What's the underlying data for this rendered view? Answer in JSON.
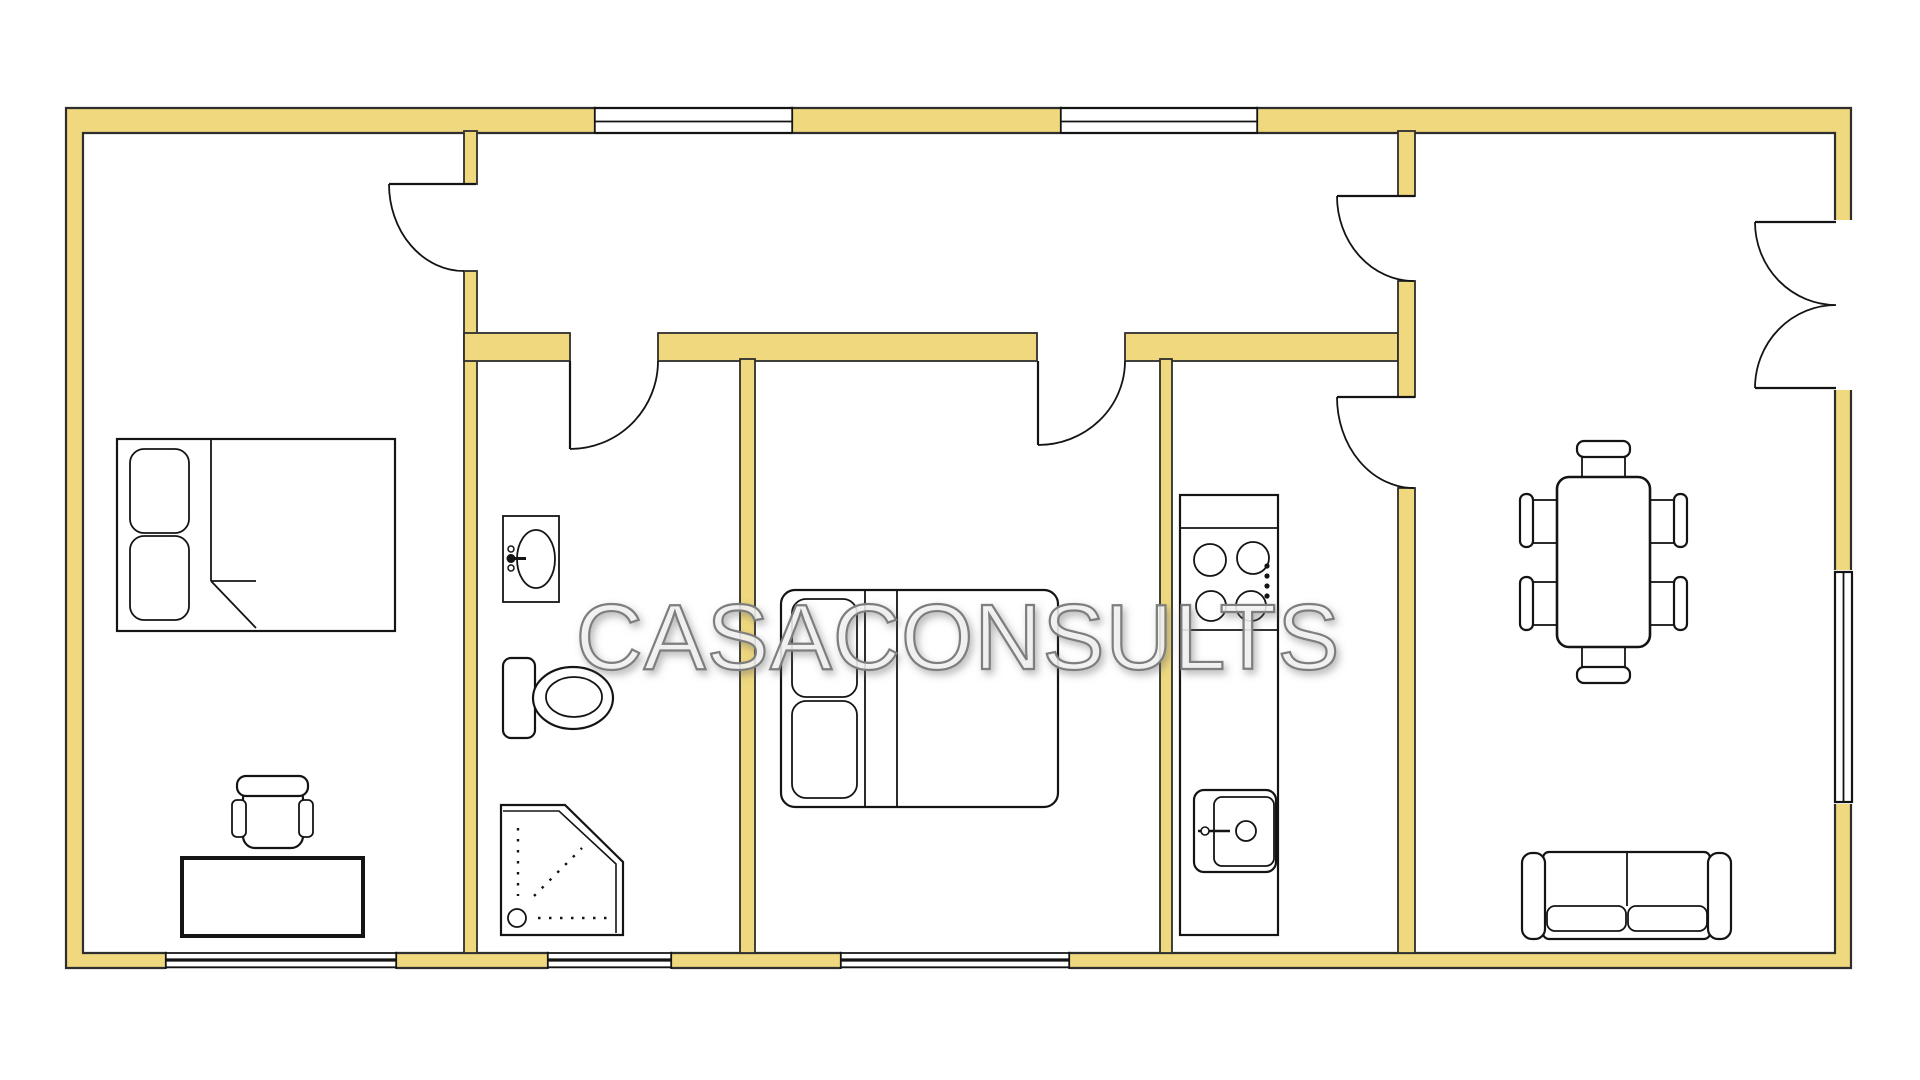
{
  "watermark": {
    "text": "CASACONSULTS"
  },
  "palette": {
    "wall_fill": "#EFD87E",
    "wall_outline": "#2E2E2E",
    "line_color": "#141414",
    "watermark_fill": "#F3F3F3",
    "watermark_outline": "#7E7E7E",
    "background": "#FFFFFF"
  },
  "plan": {
    "type": "apartment-floor-plan",
    "window_count": 6,
    "door_swing_count": 6,
    "rooms": [
      {
        "name": "bedroom-left",
        "fixtures": [
          "double-bed",
          "pillows",
          "desk",
          "office-chair"
        ]
      },
      {
        "name": "hallway",
        "fixtures": []
      },
      {
        "name": "bathroom",
        "fixtures": [
          "washbasin",
          "toilet",
          "corner-shower"
        ]
      },
      {
        "name": "bedroom-middle",
        "fixtures": [
          "double-bed",
          "pillows"
        ]
      },
      {
        "name": "kitchen",
        "fixtures": [
          "kitchen-counter",
          "cooktop-4-burners",
          "kitchen-sink"
        ]
      },
      {
        "name": "living-dining-room",
        "fixtures": [
          "dining-table",
          "dining-chairs-x6",
          "sofa",
          "double-entrance-door"
        ]
      }
    ]
  }
}
